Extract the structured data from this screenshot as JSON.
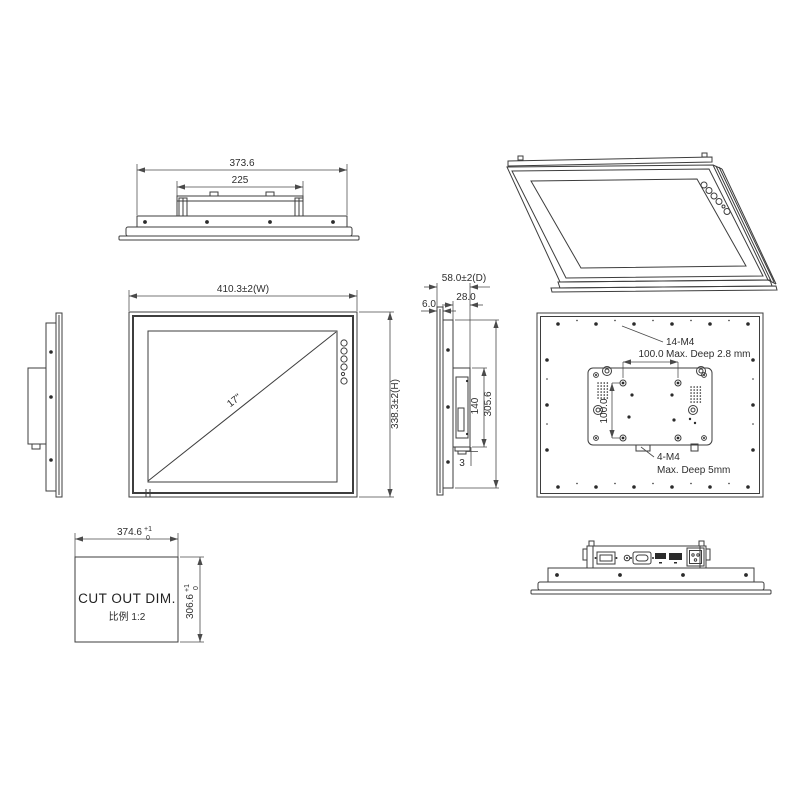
{
  "views": {
    "top": {
      "dims": {
        "overall": "373.6",
        "bracket": "225"
      }
    },
    "front": {
      "dims": {
        "width": "410.3±2(W)",
        "height": "338.3±2(H)",
        "diagonal": "17\""
      }
    },
    "side": {
      "dims": {
        "depth": "58.0±2(D)",
        "rear": "28.0",
        "bezel": "6.0",
        "module": "140",
        "body": "305.6",
        "gap": "3"
      }
    },
    "rear": {
      "perimeter_label": "14-M4",
      "perimeter_note": "Max. Deep 2.8 mm",
      "vesa_w": "100.0",
      "vesa_h": "100.0",
      "vesa_label": "4-M4",
      "vesa_note": "Max. Deep 5mm"
    },
    "cutout": {
      "title": "CUT OUT DIM.",
      "scale_label": "比例 1:2",
      "dims": {
        "width": "374.6",
        "width_tol_up": "+1",
        "width_tol_low": "0",
        "height": "306.6",
        "height_tol_up": "+1",
        "height_tol_low": "0"
      }
    }
  }
}
